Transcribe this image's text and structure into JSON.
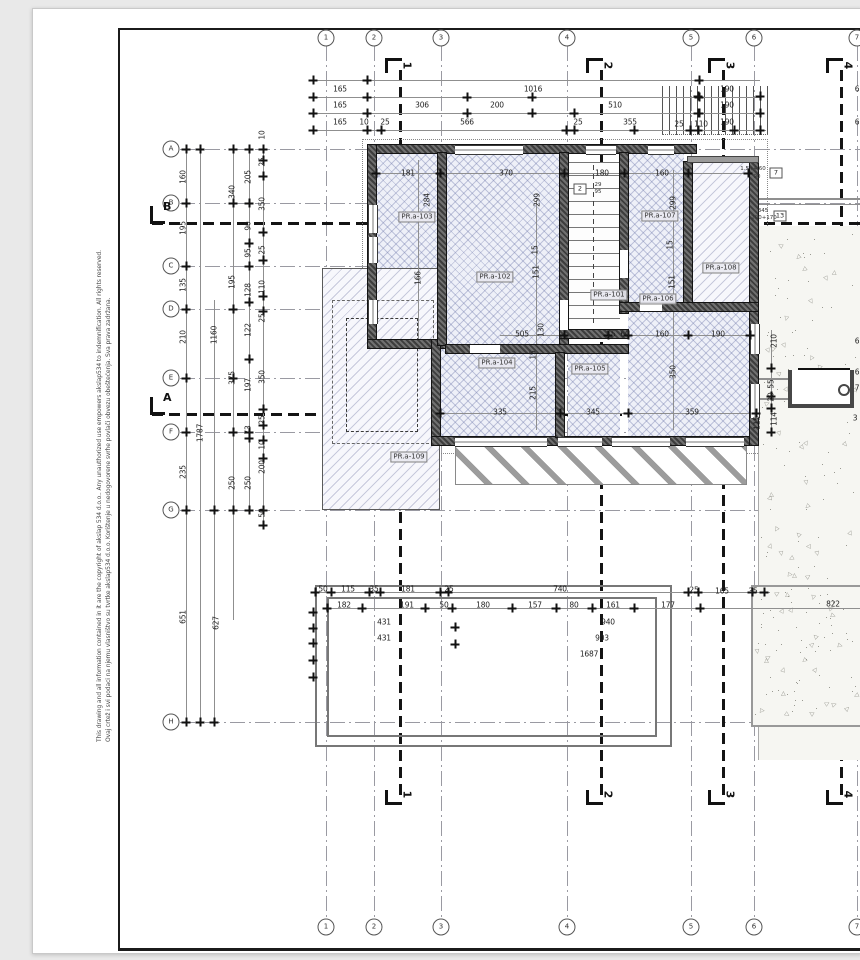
{
  "sheet": {
    "copyright_hr": "Ovaj crtež i svi podaci na njemu vlasništvo su tvrtke akslap534 d.o.o. Korištenje u nedogovorene svrhe povlači obvezu obeštećenja. Sva prava zadržana.",
    "copyright_en": "This drawing and all information contained in it are the copyright of akslap 534 d.o.o.. Any unauthorized use empowers akslap534 to indemnification. All rights reserved."
  },
  "grid": {
    "cols": [
      {
        "label": "1",
        "x": 326
      },
      {
        "label": "2",
        "x": 374
      },
      {
        "label": "3",
        "x": 441
      },
      {
        "label": "4",
        "x": 567
      },
      {
        "label": "5",
        "x": 691
      },
      {
        "label": "6",
        "x": 754
      },
      {
        "label": "7",
        "x": 857
      }
    ],
    "rows": [
      {
        "label": "A",
        "y": 149
      },
      {
        "label": "B",
        "y": 203
      },
      {
        "label": "C",
        "y": 266
      },
      {
        "label": "D",
        "y": 309
      },
      {
        "label": "E",
        "y": 378
      },
      {
        "label": "F",
        "y": 432
      },
      {
        "label": "G",
        "y": 510
      },
      {
        "label": "H",
        "y": 722
      }
    ]
  },
  "sections": {
    "vertical": [
      {
        "label": "1",
        "x": 399
      },
      {
        "label": "2",
        "x": 600
      },
      {
        "label": "3",
        "x": 722
      },
      {
        "label": "4",
        "x": 840
      }
    ],
    "horizontal": [
      {
        "label": "B",
        "y": 222
      },
      {
        "label": "A",
        "y": 413
      }
    ]
  },
  "rooms": [
    {
      "label": "PR.a-101",
      "x": 609,
      "y": 295
    },
    {
      "label": "PR.a-102",
      "x": 495,
      "y": 277
    },
    {
      "label": "PR.a-103",
      "x": 417,
      "y": 217
    },
    {
      "label": "PR.a-104",
      "x": 497,
      "y": 363
    },
    {
      "label": "PR.a-105",
      "x": 590,
      "y": 369
    },
    {
      "label": "PR.a-106",
      "x": 658,
      "y": 299
    },
    {
      "label": "PR.a-107",
      "x": 660,
      "y": 216
    },
    {
      "label": "PR.a-108",
      "x": 721,
      "y": 268
    },
    {
      "label": "PR.a-109",
      "x": 409,
      "y": 457
    }
  ],
  "tags": [
    {
      "label": "2",
      "x": 580,
      "y": 189
    },
    {
      "label": "7",
      "x": 776,
      "y": 173
    },
    {
      "label": "13",
      "x": 780,
      "y": 216
    }
  ],
  "annotations": [
    {
      "text": "1.5+4.60",
      "x": 753,
      "y": 169
    },
    {
      "text": "90",
      "x": 757,
      "y": 177
    },
    {
      "text": "345",
      "x": 763,
      "y": 211
    },
    {
      "text": "200+170",
      "x": 764,
      "y": 218
    },
    {
      "text": "29",
      "x": 598,
      "y": 185
    },
    {
      "text": "95",
      "x": 598,
      "y": 192
    }
  ],
  "dims": [
    {
      "t": "165",
      "x": 340,
      "y": 89,
      "r": 0
    },
    {
      "t": "165",
      "x": 340,
      "y": 105,
      "r": 0
    },
    {
      "t": "165",
      "x": 340,
      "y": 122,
      "r": 0
    },
    {
      "t": "10",
      "x": 364,
      "y": 122,
      "r": 0
    },
    {
      "t": "25",
      "x": 385,
      "y": 122,
      "r": 0
    },
    {
      "t": "306",
      "x": 422,
      "y": 105,
      "r": 0
    },
    {
      "t": "566",
      "x": 467,
      "y": 122,
      "r": 0
    },
    {
      "t": "200",
      "x": 497,
      "y": 105,
      "r": 0
    },
    {
      "t": "1016",
      "x": 533,
      "y": 89,
      "r": 0
    },
    {
      "t": "510",
      "x": 615,
      "y": 105,
      "r": 0
    },
    {
      "t": "25",
      "x": 578,
      "y": 122,
      "r": 0
    },
    {
      "t": "355",
      "x": 630,
      "y": 122,
      "r": 0
    },
    {
      "t": "25",
      "x": 679,
      "y": 124,
      "r": 0
    },
    {
      "t": "110",
      "x": 701,
      "y": 124,
      "r": 0
    },
    {
      "t": "190",
      "x": 727,
      "y": 89,
      "r": 0
    },
    {
      "t": "190",
      "x": 727,
      "y": 105,
      "r": 0
    },
    {
      "t": "190",
      "x": 727,
      "y": 122,
      "r": 0
    },
    {
      "t": "6",
      "x": 857,
      "y": 89,
      "r": 0
    },
    {
      "t": "6",
      "x": 857,
      "y": 122,
      "r": 0
    },
    {
      "t": "160",
      "x": 183,
      "y": 177,
      "r": 1
    },
    {
      "t": "195",
      "x": 183,
      "y": 228,
      "r": 1
    },
    {
      "t": "135",
      "x": 183,
      "y": 285,
      "r": 1
    },
    {
      "t": "210",
      "x": 183,
      "y": 337,
      "r": 1
    },
    {
      "t": "235",
      "x": 183,
      "y": 472,
      "r": 1
    },
    {
      "t": "651",
      "x": 183,
      "y": 617,
      "r": 1
    },
    {
      "t": "1787",
      "x": 200,
      "y": 433,
      "r": 1
    },
    {
      "t": "1160",
      "x": 214,
      "y": 335,
      "r": 1
    },
    {
      "t": "627",
      "x": 216,
      "y": 623,
      "r": 1
    },
    {
      "t": "340",
      "x": 232,
      "y": 192,
      "r": 1
    },
    {
      "t": "195",
      "x": 232,
      "y": 282,
      "r": 1
    },
    {
      "t": "375",
      "x": 232,
      "y": 378,
      "r": 1
    },
    {
      "t": "250",
      "x": 232,
      "y": 483,
      "r": 1
    },
    {
      "t": "205",
      "x": 248,
      "y": 177,
      "r": 1
    },
    {
      "t": "90",
      "x": 248,
      "y": 226,
      "r": 1
    },
    {
      "t": "95",
      "x": 248,
      "y": 253,
      "r": 1
    },
    {
      "t": "128",
      "x": 248,
      "y": 290,
      "r": 1
    },
    {
      "t": "122",
      "x": 248,
      "y": 330,
      "r": 1
    },
    {
      "t": "197",
      "x": 248,
      "y": 385,
      "r": 1
    },
    {
      "t": "73",
      "x": 248,
      "y": 430,
      "r": 1
    },
    {
      "t": "250",
      "x": 248,
      "y": 483,
      "r": 1
    },
    {
      "t": "10",
      "x": 262,
      "y": 135,
      "r": 1
    },
    {
      "t": "25",
      "x": 262,
      "y": 162,
      "r": 1
    },
    {
      "t": "350",
      "x": 262,
      "y": 204,
      "r": 1
    },
    {
      "t": "25",
      "x": 262,
      "y": 250,
      "r": 1
    },
    {
      "t": "110",
      "x": 262,
      "y": 287,
      "r": 1
    },
    {
      "t": "25",
      "x": 262,
      "y": 318,
      "r": 1
    },
    {
      "t": "350",
      "x": 262,
      "y": 377,
      "r": 1
    },
    {
      "t": "25",
      "x": 262,
      "y": 420,
      "r": 1
    },
    {
      "t": "10",
      "x": 262,
      "y": 445,
      "r": 1
    },
    {
      "t": "200",
      "x": 262,
      "y": 467,
      "r": 1
    },
    {
      "t": "50",
      "x": 262,
      "y": 513,
      "r": 1
    },
    {
      "t": "181",
      "x": 408,
      "y": 173,
      "r": 0
    },
    {
      "t": "370",
      "x": 506,
      "y": 173,
      "r": 0
    },
    {
      "t": "180",
      "x": 602,
      "y": 173,
      "r": 0
    },
    {
      "t": "160",
      "x": 662,
      "y": 173,
      "r": 0
    },
    {
      "t": "284",
      "x": 427,
      "y": 200,
      "r": 1
    },
    {
      "t": "299",
      "x": 537,
      "y": 200,
      "r": 1
    },
    {
      "t": "299",
      "x": 673,
      "y": 203,
      "r": 1
    },
    {
      "t": "166",
      "x": 418,
      "y": 278,
      "r": 1
    },
    {
      "t": "151",
      "x": 536,
      "y": 272,
      "r": 1
    },
    {
      "t": "15",
      "x": 535,
      "y": 250,
      "r": 1
    },
    {
      "t": "15",
      "x": 670,
      "y": 245,
      "r": 1
    },
    {
      "t": "151",
      "x": 672,
      "y": 282,
      "r": 1
    },
    {
      "t": "505",
      "x": 522,
      "y": 334,
      "r": 0
    },
    {
      "t": "130",
      "x": 541,
      "y": 330,
      "r": 1
    },
    {
      "t": "15",
      "x": 611,
      "y": 334,
      "r": 0
    },
    {
      "t": "60",
      "x": 625,
      "y": 334,
      "r": 0
    },
    {
      "t": "160",
      "x": 662,
      "y": 334,
      "r": 0
    },
    {
      "t": "190",
      "x": 718,
      "y": 334,
      "r": 0
    },
    {
      "t": "215",
      "x": 533,
      "y": 393,
      "r": 1
    },
    {
      "t": "15",
      "x": 533,
      "y": 355,
      "r": 1
    },
    {
      "t": "350",
      "x": 673,
      "y": 372,
      "r": 1
    },
    {
      "t": "335",
      "x": 500,
      "y": 412,
      "r": 0
    },
    {
      "t": "345",
      "x": 593,
      "y": 412,
      "r": 0
    },
    {
      "t": "359",
      "x": 692,
      "y": 412,
      "r": 0
    },
    {
      "t": "210",
      "x": 774,
      "y": 341,
      "r": 1
    },
    {
      "t": "55",
      "x": 771,
      "y": 384,
      "r": 1
    },
    {
      "t": "20",
      "x": 771,
      "y": 397,
      "r": 1
    },
    {
      "t": "114",
      "x": 774,
      "y": 419,
      "r": 1
    },
    {
      "t": "115",
      "x": 757,
      "y": 423,
      "r": 1
    },
    {
      "t": "50",
      "x": 323,
      "y": 589,
      "r": 0
    },
    {
      "t": "115",
      "x": 348,
      "y": 589,
      "r": 0
    },
    {
      "t": "35",
      "x": 374,
      "y": 589,
      "r": 0
    },
    {
      "t": "181",
      "x": 408,
      "y": 589,
      "r": 0
    },
    {
      "t": "25",
      "x": 449,
      "y": 589,
      "r": 0
    },
    {
      "t": "740",
      "x": 560,
      "y": 589,
      "r": 0
    },
    {
      "t": "25",
      "x": 694,
      "y": 590,
      "r": 0
    },
    {
      "t": "165",
      "x": 722,
      "y": 591,
      "r": 0
    },
    {
      "t": "35",
      "x": 753,
      "y": 591,
      "r": 0
    },
    {
      "t": "182",
      "x": 344,
      "y": 605,
      "r": 0
    },
    {
      "t": "191",
      "x": 407,
      "y": 605,
      "r": 0
    },
    {
      "t": "50",
      "x": 444,
      "y": 605,
      "r": 0
    },
    {
      "t": "180",
      "x": 483,
      "y": 605,
      "r": 0
    },
    {
      "t": "157",
      "x": 535,
      "y": 605,
      "r": 0
    },
    {
      "t": "80",
      "x": 574,
      "y": 605,
      "r": 0
    },
    {
      "t": "161",
      "x": 613,
      "y": 605,
      "r": 0
    },
    {
      "t": "177",
      "x": 668,
      "y": 605,
      "r": 0
    },
    {
      "t": "822",
      "x": 833,
      "y": 604,
      "r": 0
    },
    {
      "t": "431",
      "x": 384,
      "y": 622,
      "r": 0
    },
    {
      "t": "431",
      "x": 384,
      "y": 638,
      "r": 0
    },
    {
      "t": "940",
      "x": 608,
      "y": 622,
      "r": 0
    },
    {
      "t": "903",
      "x": 602,
      "y": 638,
      "r": 0
    },
    {
      "t": "1687",
      "x": 589,
      "y": 654,
      "r": 0
    },
    {
      "t": "6",
      "x": 857,
      "y": 341,
      "r": 0
    },
    {
      "t": "6",
      "x": 857,
      "y": 372,
      "r": 0
    },
    {
      "t": "7",
      "x": 857,
      "y": 388,
      "r": 0
    },
    {
      "t": "3",
      "x": 855,
      "y": 418,
      "r": 0
    }
  ],
  "colors": {
    "paper": "#ffffff",
    "background": "#e9e9e9",
    "frame": "#1b1b1b",
    "grid": "#9a9aa2",
    "wall": "#3d3d3d",
    "floor_hatch": "#6e78aa",
    "terrace": "#f7f7fc",
    "dim_text": "#1f1f1f"
  }
}
